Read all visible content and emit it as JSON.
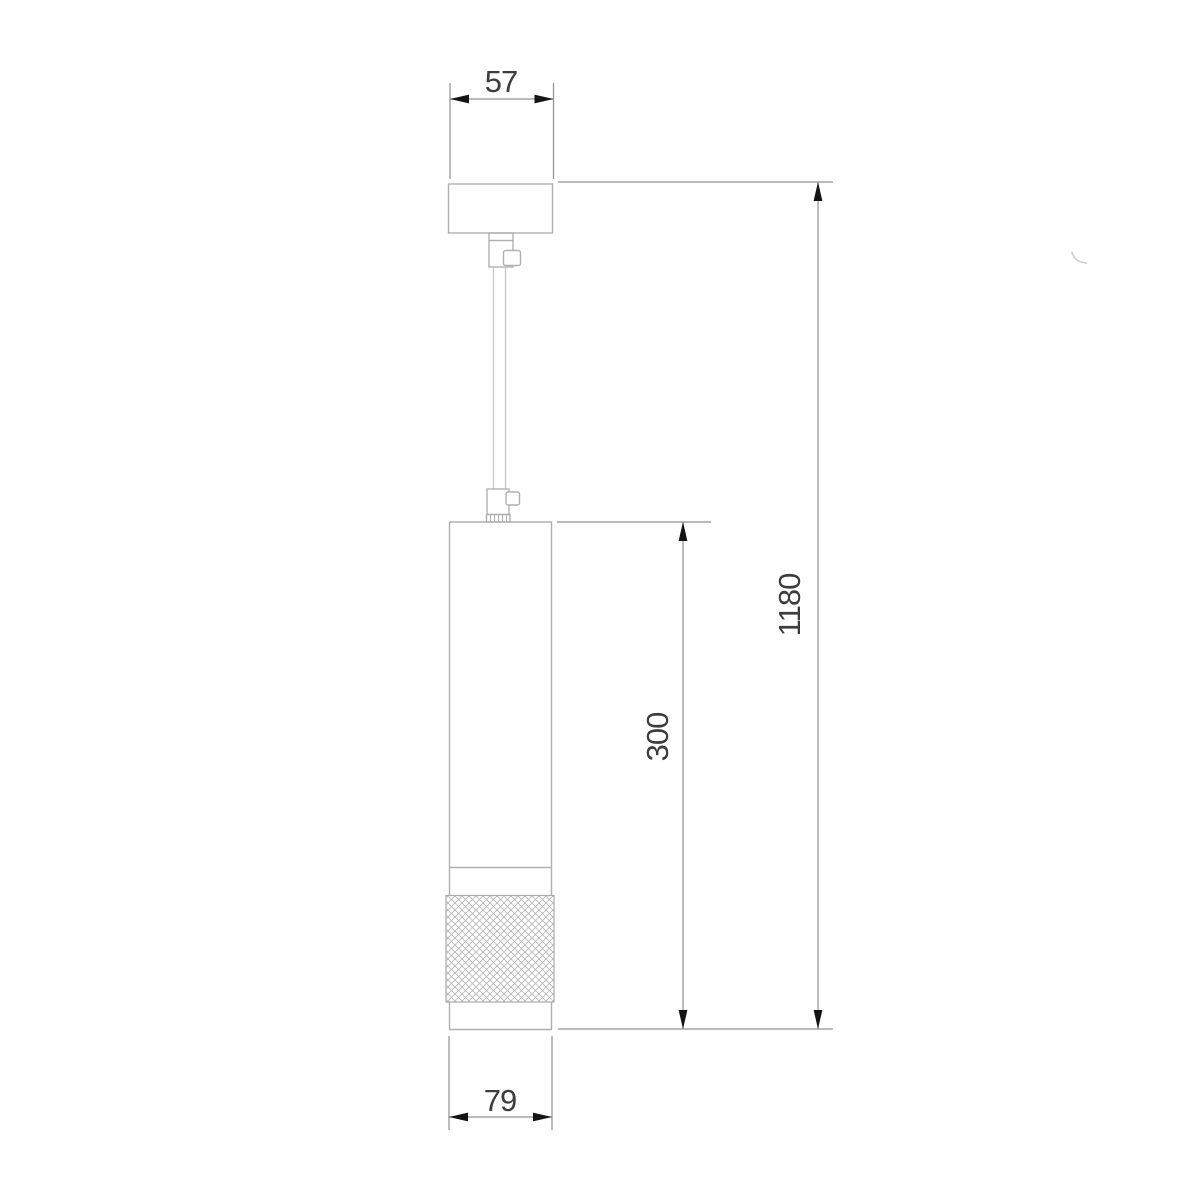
{
  "page": {
    "background": "#ffffff"
  },
  "drawing": {
    "type": "technical-line-drawing",
    "subject": "pendant light fixture side elevation with dimensions",
    "dimensions": [
      {
        "id": "canopy-width",
        "label": "57",
        "orientation": "horizontal",
        "location": "top",
        "measures": "ceiling canopy width"
      },
      {
        "id": "overall-drop",
        "label": "1180",
        "orientation": "vertical",
        "location": "right-outer",
        "measures": "overall hanging height"
      },
      {
        "id": "body-height",
        "label": "300",
        "orientation": "vertical",
        "location": "right-inner",
        "measures": "lamp body height"
      },
      {
        "id": "body-diameter",
        "label": "79",
        "orientation": "horizontal",
        "location": "bottom",
        "measures": "lamp body diameter"
      }
    ],
    "parts": [
      "ceiling-canopy",
      "cord-grip-upper",
      "suspension-cable",
      "cord-grip-lower",
      "lamp-body",
      "knurled-ring",
      "bottom-ring"
    ],
    "colors": {
      "outline": "#b0b0b0",
      "cable": "#c6c6c6",
      "dimension_line": "#909090",
      "arrowhead": "#141414",
      "label_text": "#3d3d3d",
      "knurl_hatch": "#b8b8b8",
      "background": "#ffffff"
    }
  }
}
